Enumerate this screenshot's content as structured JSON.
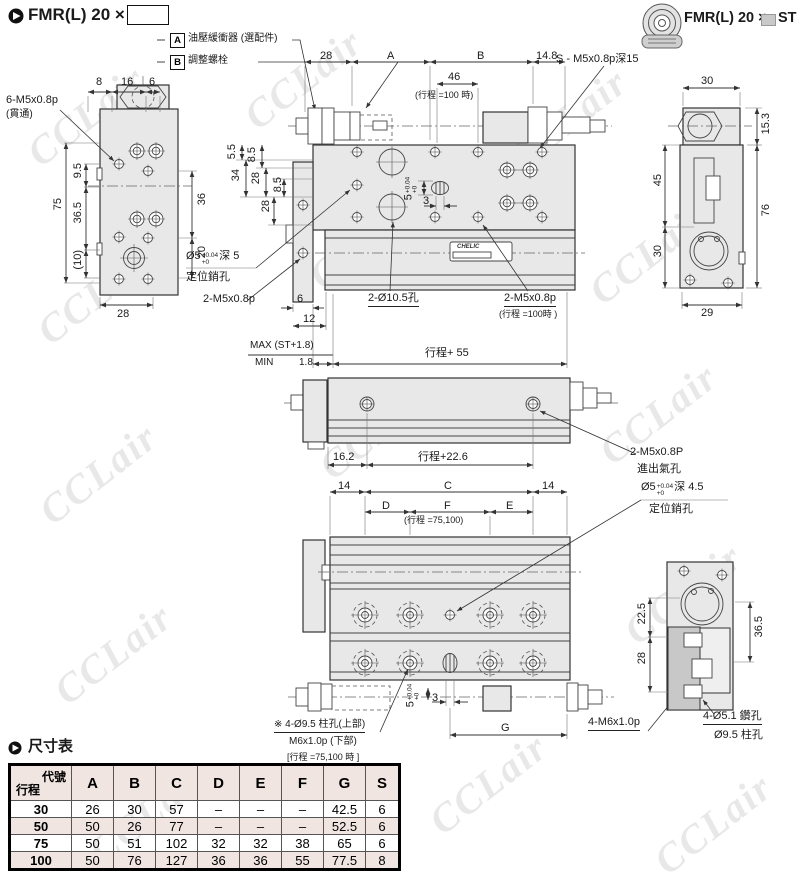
{
  "watermark": {
    "text": "CCLair"
  },
  "header": {
    "title_left": "FMR(L)  20 ×",
    "model_right": "FMR(L) 20 ×",
    "suffix_right": "ST"
  },
  "notes": {
    "a_key": "A",
    "a_text": "油壓緩衝器 (選配件)",
    "b_key": "B",
    "b_text": "調整螺栓"
  },
  "left_view": {
    "thread_label": "6-M5x0.8p",
    "through": "(貫通)",
    "d8": "8",
    "d16": "16",
    "d6": "6",
    "d75": "75",
    "d9_5": "9.5",
    "d36_5": "36.5",
    "d10": "(10)",
    "d36": "36",
    "d20": "20",
    "d28": "28"
  },
  "top_view": {
    "d28": "28",
    "dA": "A",
    "dB": "B",
    "d14_8": "14.8",
    "d46": "46",
    "d46_note": "(行程 =100 時)",
    "s_label": "S - M5x0.8p深15",
    "d5_5": "5.5",
    "d8_5a": "8.5",
    "d34": "34",
    "d28a": "28",
    "d8_5b": "8.5",
    "d28b": "28",
    "pin_base": "Ø5",
    "pin_tol_top": "+0.04",
    "pin_tol_bot": "+0",
    "pin_depth": "深 5",
    "pin_line2": "定位銷孔",
    "m5_label": "2-M5x0.8p",
    "hole_label": "2-Ø10.5孔",
    "m5b_label": "2-M5x0.8p",
    "m5b_note": "(行程 =100時 )",
    "d6": "6",
    "d12": "12",
    "slot_base": "5",
    "slot_tol_top": "+0.04",
    "slot_tol_bot": "+0",
    "d3": "3",
    "max_label": "MAX  (ST+1.8)",
    "min_label": "MIN",
    "min_value": "1.8",
    "stroke_label": "行程+ 55",
    "nameplate": "CHELIC"
  },
  "right_view": {
    "d30_top": "30",
    "d15_3": "15.3",
    "d45": "45",
    "d76": "76",
    "d30_left": "30",
    "d29": "29"
  },
  "side_view": {
    "d16_2": "16.2",
    "stroke_label": "行程+22.6",
    "port_label": "2-M5x0.8P",
    "port_label2": "進出氣孔"
  },
  "bottom_view": {
    "d14l": "14",
    "dC": "C",
    "d14r": "14",
    "dD": "D",
    "dF": "F",
    "dE": "E",
    "df_note": "(行程 =75,100)",
    "pin_base": "Ø5",
    "pin_tol_top": "+0.04",
    "pin_tol_bot": "+0",
    "pin_depth": "深 4.5",
    "pin_line2": "定位銷孔",
    "cb_line1": "※ 4-Ø9.5 柱孔(上部)",
    "cb_line2": "M6x1.0p (下部)",
    "cb_line3": "[行程 =75,100 時 ]",
    "slot_base": "5",
    "slot_tol_top": "+0.04",
    "slot_tol_bot": "+0",
    "d3": "3",
    "dG": "G",
    "thread_label": "4-M6x1.0p"
  },
  "corner_view": {
    "d22_5": "22.5",
    "d28": "28",
    "d36_5": "36.5",
    "drill_label": "4-Ø5.1 鑽孔",
    "cbore_label": "Ø9.5 柱孔"
  },
  "dim_table": {
    "title": "尺寸表",
    "corner_top": "代號",
    "corner_bottom": "行程",
    "columns": [
      "A",
      "B",
      "C",
      "D",
      "E",
      "F",
      "G",
      "S"
    ],
    "rows": [
      {
        "stroke": "30",
        "values": [
          "26",
          "30",
          "57",
          "–",
          "–",
          "–",
          "42.5",
          "6"
        ]
      },
      {
        "stroke": "50",
        "values": [
          "50",
          "26",
          "77",
          "–",
          "–",
          "–",
          "52.5",
          "6"
        ]
      },
      {
        "stroke": "75",
        "values": [
          "50",
          "51",
          "102",
          "32",
          "32",
          "38",
          "65",
          "6"
        ]
      },
      {
        "stroke": "100",
        "values": [
          "50",
          "76",
          "127",
          "36",
          "36",
          "55",
          "77.5",
          "8"
        ]
      }
    ]
  },
  "colors": {
    "drawing_fill": "#e8e8e8",
    "table_accent": "#f0e5e1"
  }
}
